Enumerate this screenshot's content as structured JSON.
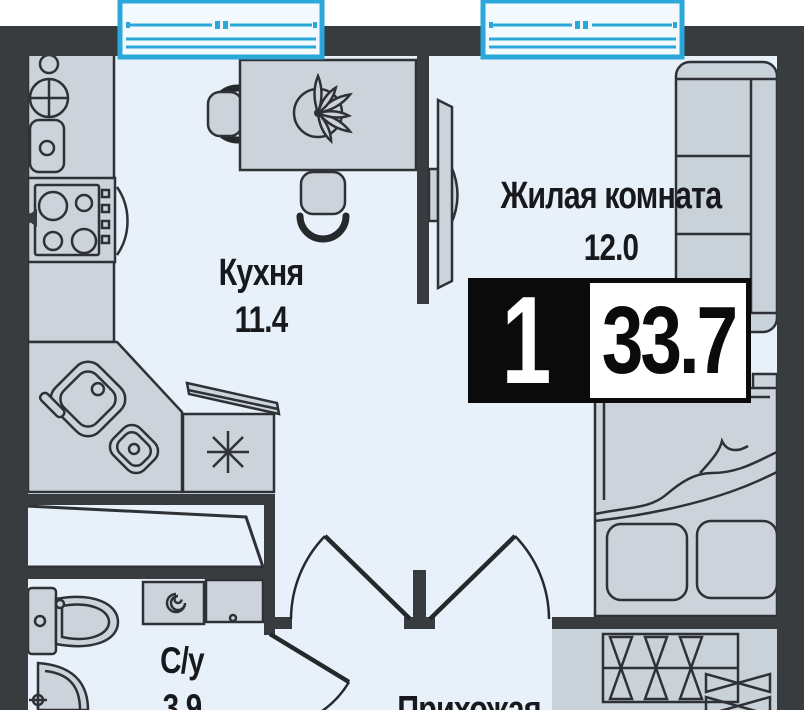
{
  "badge": {
    "rooms_count": "1",
    "total_area": "33.7"
  },
  "rooms": {
    "kitchen": {
      "name": "Кухня",
      "area": "11.4"
    },
    "living_room": {
      "name": "Жилая комната",
      "area": "12.0"
    },
    "bathroom": {
      "name": "С/у",
      "area": "3.9"
    },
    "hallway": {
      "name": "Прихожая"
    }
  },
  "legend_icons": [
    "window-icon",
    "dining-table-icon",
    "plant-icon",
    "chair-icon",
    "gas-stove-icon",
    "round-sink-icon",
    "corner-sink-icon",
    "dishwasher-icon",
    "tv-icon",
    "wardrobe-icon",
    "bed-icon",
    "pillow-icon",
    "bedside-table-icon",
    "closet-hangers-icon",
    "shower-icon",
    "toilet-icon",
    "washing-machine-icon",
    "bathroom-sink-icon",
    "door-swing-icon"
  ],
  "colors": {
    "wall": "#393c3f",
    "floor": "#e8f1fa",
    "furniture_fill": "#ccd3da",
    "outline": "#2e3236",
    "window_accent": "#2ba7d9",
    "badge_black": "#0b0b0b",
    "label_text": "#17191c"
  }
}
